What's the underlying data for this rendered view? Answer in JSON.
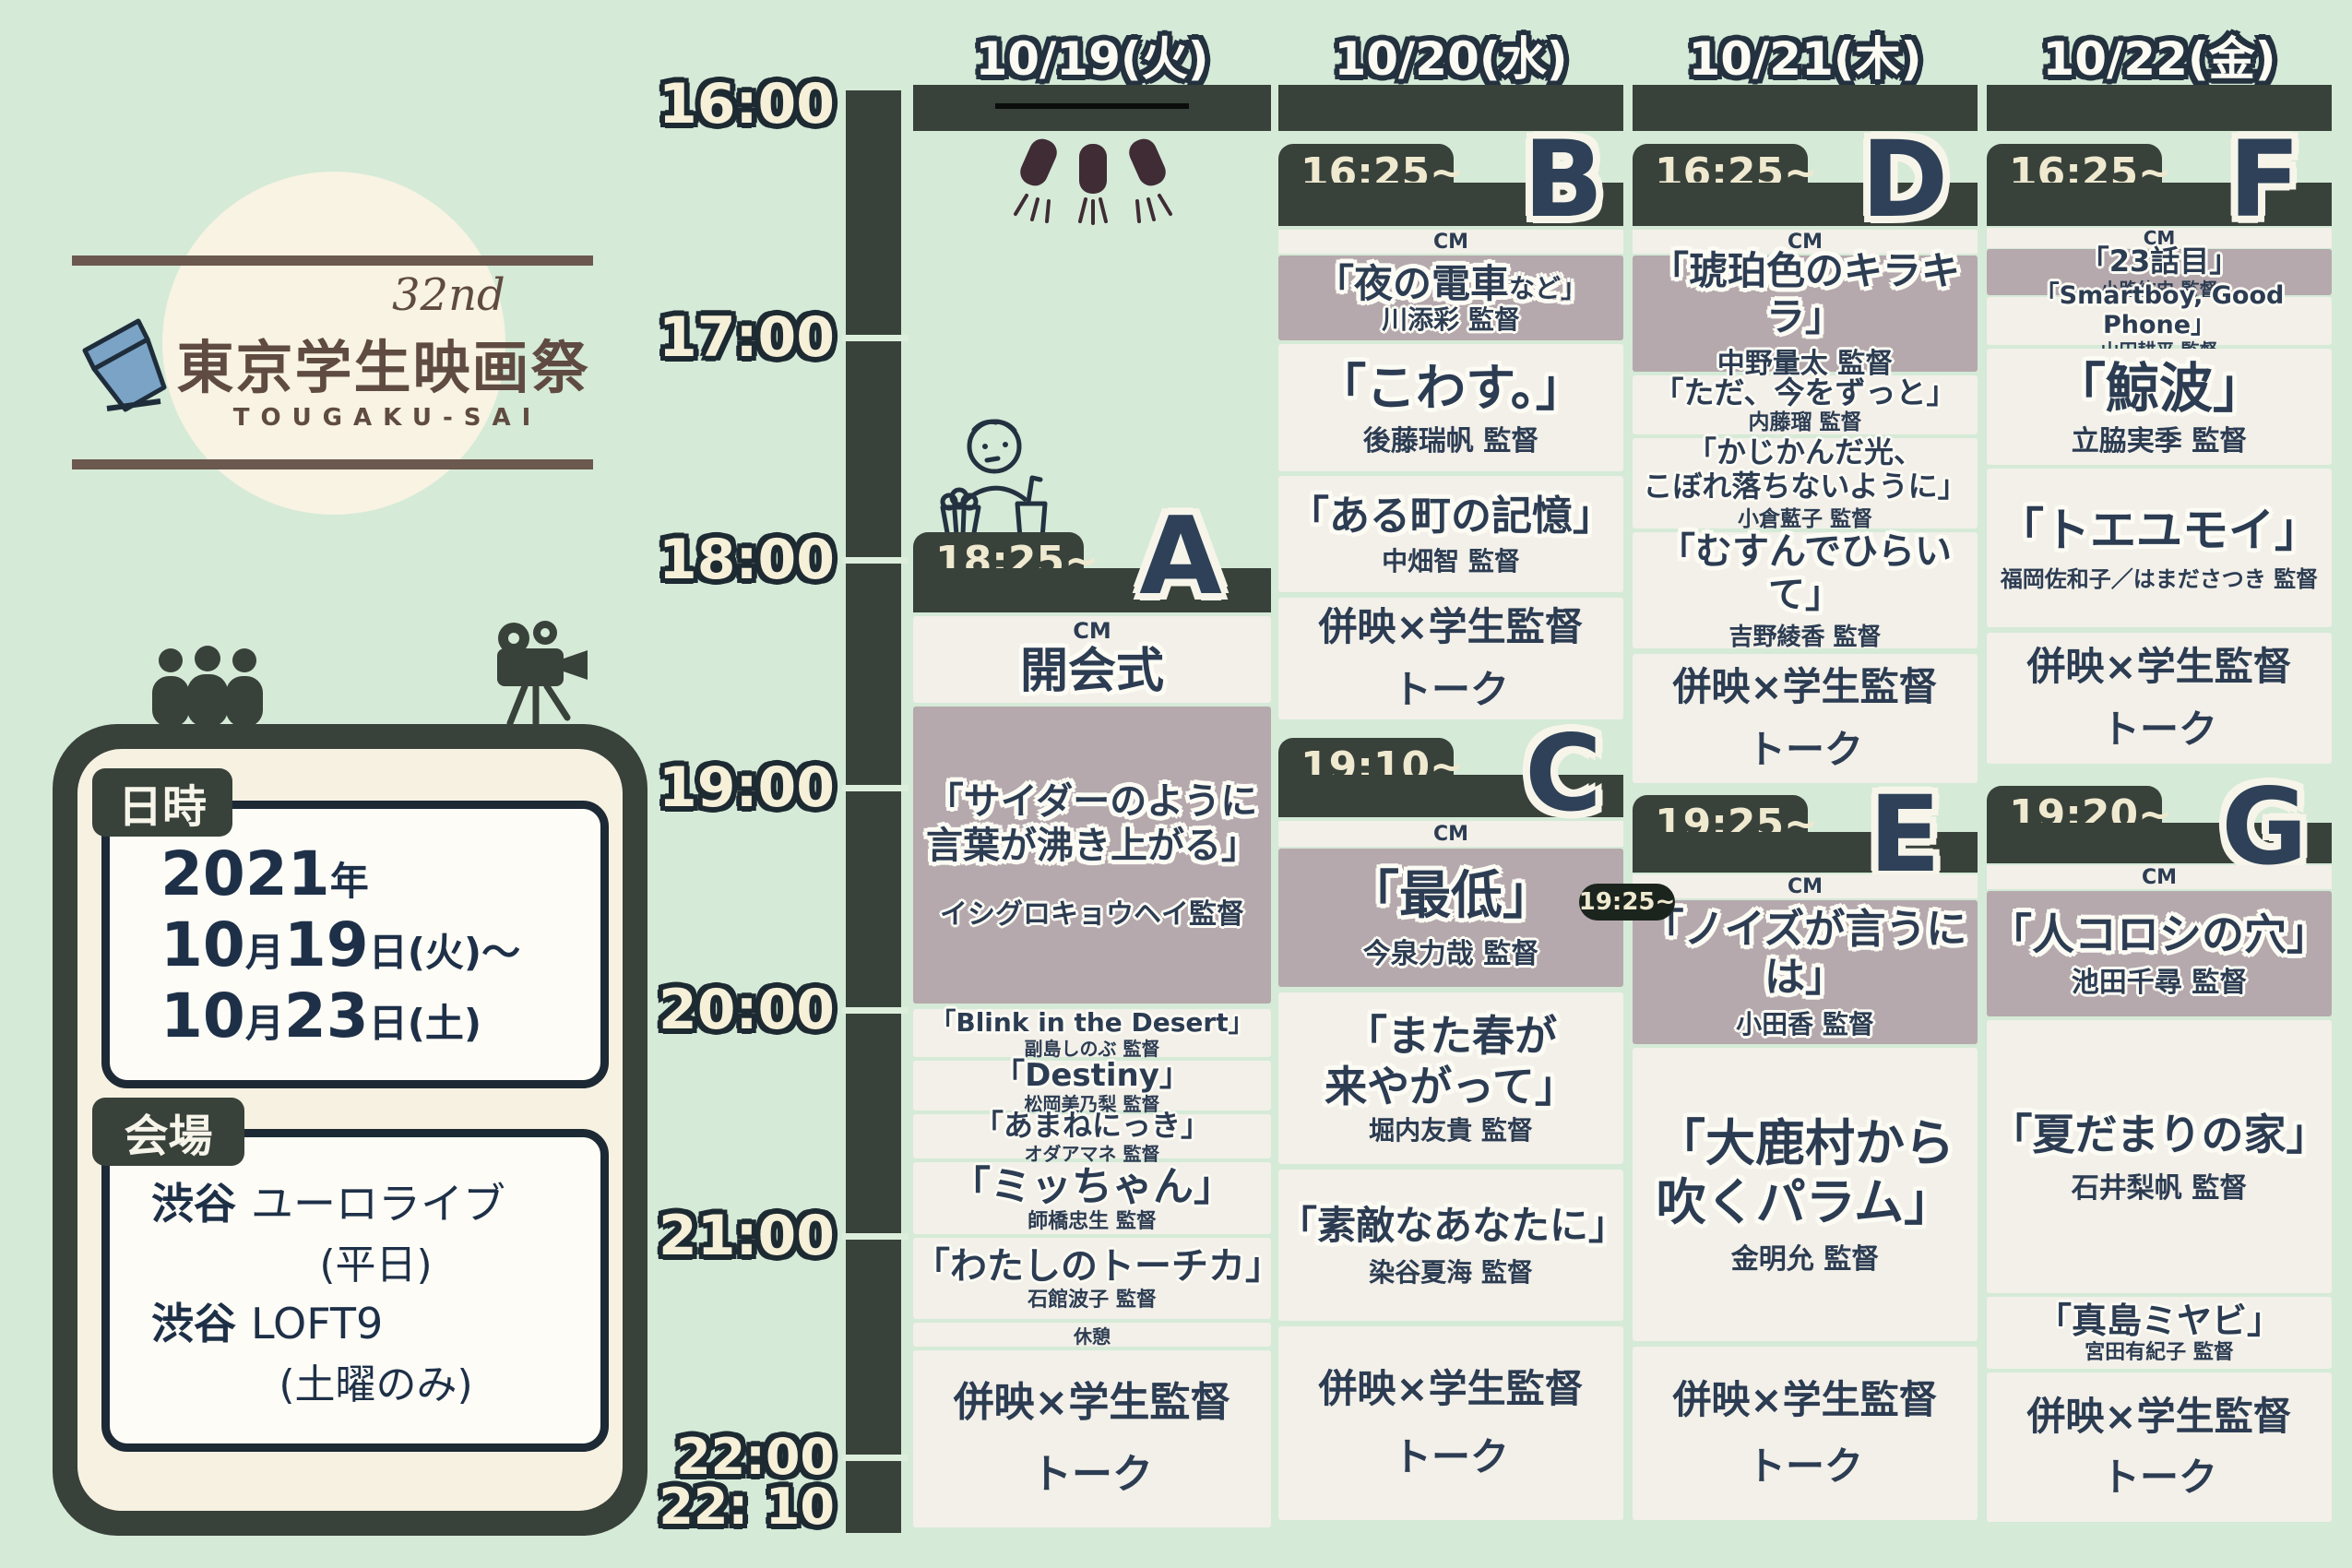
{
  "logo": {
    "edition": "32nd",
    "title": "東京学生映画祭",
    "subtitle": "TOUGAKU-SAI"
  },
  "info": {
    "date_tag": "日時",
    "d1_num": "2021",
    "d1_unit": "年",
    "d2_n1": "10",
    "d2_u1": "月",
    "d2_n2": "19",
    "d2_u2": "日(火)〜",
    "d3_n1": "10",
    "d3_u1": "月",
    "d3_n2": "23",
    "d3_u2": "日(土)",
    "venue_tag": "会場",
    "v1_b": "渋谷",
    "v1_r": "ユーロライブ",
    "v2": "(平日)",
    "v3_b": "渋谷",
    "v3_r": "LOFT9",
    "v4": "(土曜のみ)"
  },
  "timeline": {
    "t1": "16:00",
    "t2": "17:00",
    "t3": "18:00",
    "t4": "19:00",
    "t5": "20:00",
    "t6": "21:00",
    "t7": "22:00",
    "t8": "22: 10"
  },
  "colors": {
    "background": "#d5ead7",
    "panel_dark": "#38413a",
    "mauve": "#b5a9ad",
    "navy": "#2e4158",
    "cream": "#efe9cf",
    "block": "#f2f0e9"
  },
  "days": [
    {
      "date": "10/19(火)",
      "a": {
        "time": "18:25~",
        "letter": "A",
        "cm": "CM",
        "ceremony": "開会式",
        "ft1": "「サイダーのように",
        "ft2": "言葉が沸き上がる」",
        "fd": "イシグロキョウヘイ監督",
        "films": [
          {
            "t": "「Blink in the Desert」",
            "d": "副島しのぶ 監督"
          },
          {
            "t": "「Destiny」",
            "d": "松岡美乃梨 監督"
          },
          {
            "t": "「あまねにっき」",
            "d": "オダアマネ 監督"
          },
          {
            "t": "「ミッちゃん」",
            "d": "師橋忠生 監督"
          },
          {
            "t": "「わたしのトーチカ」",
            "d": "石館波子 監督"
          }
        ],
        "break_label": "休憩",
        "talk1": "併映×学生監督",
        "talk2": "トーク"
      }
    },
    {
      "date": "10/20(水)",
      "b": {
        "time": "16:25~",
        "letter": "B",
        "cm": "CM",
        "ft_main": "「夜の電車",
        "ft_small": "など」",
        "fd": "川添彩 監督",
        "f1t": "「こわす。」",
        "f1d": "後藤瑞帆 監督",
        "f2t": "「ある町の記憶」",
        "f2d": "中畑智 監督",
        "talk1": "併映×学生監督",
        "talk2": "トーク"
      },
      "c": {
        "time": "19:10~",
        "letter": "C",
        "cm": "CM",
        "ft": "「最低」",
        "fd": "今泉力哉 監督",
        "f1t1": "「また春が",
        "f1t2": "来やがって」",
        "f1d": "堀内友貴 監督",
        "f2t": "「素敵なあなたに」",
        "f2d": "染谷夏海 監督",
        "talk1": "併映×学生監督",
        "talk2": "トーク"
      }
    },
    {
      "date": "10/21(木)",
      "d": {
        "time": "16:25~",
        "letter": "D",
        "cm": "CM",
        "ft": "「琥珀色のキラキラ」",
        "fd": "中野量太 監督",
        "f1t": "「ただ、今をずっと」",
        "f1d": "内藤瑠 監督",
        "f2t1": "「かじかんだ光、",
        "f2t2": "こぼれ落ちないように」",
        "f2d": "小倉藍子 監督",
        "f3t": "「むすんでひらいて」",
        "f3d": "吉野綾香 監督",
        "talk1": "併映×学生監督",
        "talk2": "トーク"
      },
      "e": {
        "time": "19:25~",
        "letter": "E",
        "cm": "CM",
        "early": "19:25~",
        "ft": "「ノイズが言うには」",
        "fd": "小田香 監督",
        "f1t1": "「大鹿村から",
        "f1t2": "吹くパラム」",
        "f1d": "金明允 監督",
        "talk1": "併映×学生監督",
        "talk2": "トーク"
      }
    },
    {
      "date": "10/22(金)",
      "f": {
        "time": "16:25~",
        "letter": "F",
        "cm": "CM",
        "ft": "「23話目」",
        "fd": "小路紘史 監督",
        "f1t": "「Smartboy, Good Phone」",
        "f1d": "山田耕平 監督",
        "f2t": "「鯨波」",
        "f2d": "立脇実季 監督",
        "f3t": "「トエユモイ」",
        "f3d": "福岡佐和子／はまださつき 監督",
        "talk1": "併映×学生監督",
        "talk2": "トーク"
      },
      "g": {
        "time": "19:20~",
        "letter": "G",
        "cm": "CM",
        "ft": "「人コロシの穴」",
        "fd": "池田千尋 監督",
        "f1t": "「夏だまりの家」",
        "f1d": "石井梨帆 監督",
        "f2t": "「真島ミヤビ」",
        "f2d": "宮田有紀子 監督",
        "talk1": "併映×学生監督",
        "talk2": "トーク"
      }
    }
  ]
}
